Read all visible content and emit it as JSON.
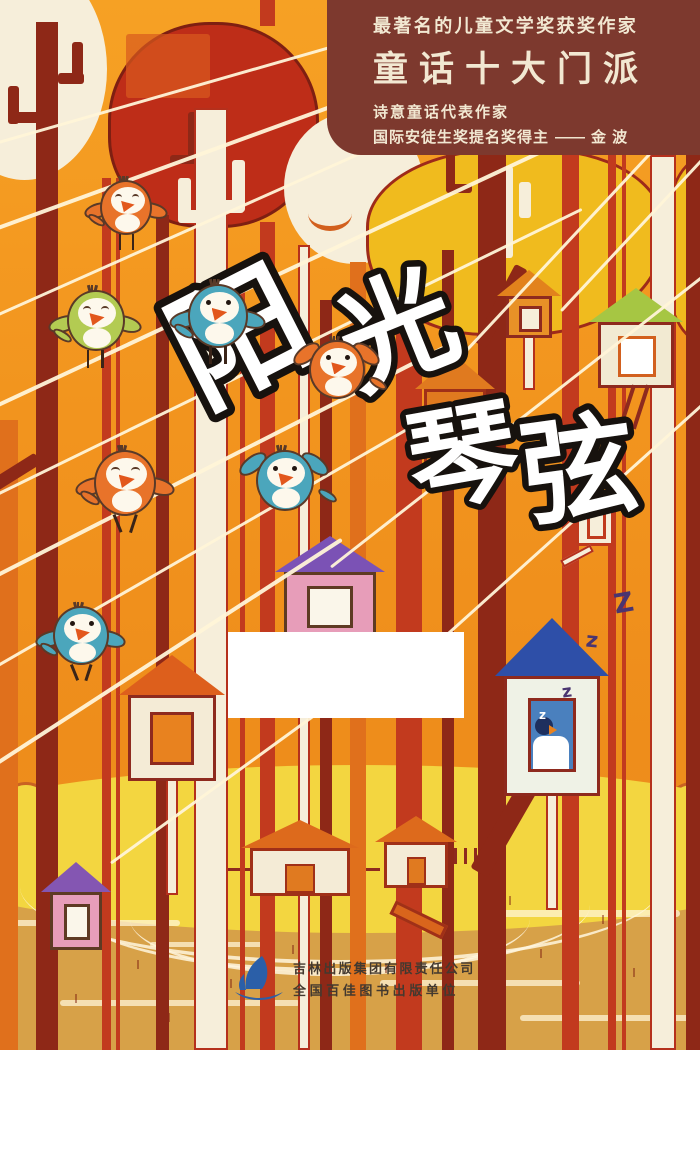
{
  "header": {
    "line1": "最著名的儿童文学奖获奖作家",
    "line2": "童话十大门派",
    "line3": "诗意童话代表作家",
    "line4_prefix": "国际安徒生奖提名奖得主",
    "line4_dash": "——",
    "line4_author": "金 波",
    "bg_color": "#7d392e",
    "text_color": "#f2e8d2"
  },
  "title": {
    "chars": [
      "阳",
      "光",
      "琴",
      "弦"
    ],
    "fill": "#ffffff",
    "stroke": "#17120e",
    "placement": [
      {
        "x": 150,
        "y": 248,
        "size": 132,
        "rot": -27
      },
      {
        "x": 305,
        "y": 236,
        "size": 116,
        "rot": -22
      },
      {
        "x": 372,
        "y": 360,
        "size": 110,
        "rot": -10
      },
      {
        "x": 488,
        "y": 374,
        "size": 114,
        "rot": -8
      }
    ]
  },
  "publisher": {
    "line1": "吉林出版集团有限责任公司",
    "line2": "全国百佳图书出版单位",
    "logo": "sailboat-logo",
    "logo_color": "#2b5fa8",
    "text_color": "#43392f"
  },
  "sleep_letters": [
    {
      "t": "z",
      "x": 562,
      "y": 682,
      "s": 17,
      "c": "#4a3570",
      "rot": -8
    },
    {
      "t": "z",
      "x": 586,
      "y": 628,
      "s": 21,
      "c": "#4a3570",
      "rot": 6
    },
    {
      "t": "Z",
      "x": 614,
      "y": 588,
      "s": 27,
      "c": "#4a3570",
      "rot": -10
    },
    {
      "t": "z",
      "x": 539,
      "y": 708,
      "s": 12,
      "c": "#ffffff",
      "rot": 0
    }
  ],
  "palette": {
    "sky_orange": "#f2941e",
    "maroon": "#8e2817",
    "red": "#c23a1e",
    "orange_trunk": "#e0701c",
    "cream": "#f6eeda",
    "canopy_red": "#be2d18",
    "canopy_yellow": "#f0bb1e",
    "bush_yellow": "#f3d640",
    "ground_tan": "#d7a148",
    "string_white": "#fff4d8",
    "bird_blue": "#4ba6bc",
    "bird_orange": "#e8732a",
    "bird_green": "#b3cb52",
    "outline_brown": "#5a3a28"
  },
  "scene": {
    "canopies": [
      {
        "n": "canopy-cream-left",
        "x": -58,
        "y": -42,
        "w": 165,
        "h": 222,
        "c": "#f6eeda",
        "rad": "50%",
        "bc": "none"
      },
      {
        "n": "canopy-red",
        "x": 108,
        "y": 22,
        "w": 205,
        "h": 200,
        "c": "#be2d18",
        "rad": "48% 48% 46% 44%",
        "bc": "#7e1f12"
      },
      {
        "n": "canopy-cream-mid",
        "x": 284,
        "y": 112,
        "w": 140,
        "h": 152,
        "c": "#f6eeda",
        "rad": "50%",
        "bc": "none"
      },
      {
        "n": "canopy-yellow",
        "x": 366,
        "y": 148,
        "w": 292,
        "h": 182,
        "c": "#f0bb1e",
        "rad": "46% 42% 46% 40% / 42% 40% 52% 48%",
        "bc": "#9e2a1a"
      },
      {
        "n": "canopy-yellow-right",
        "x": 662,
        "y": 158,
        "w": 70,
        "h": 178,
        "c": "#f0bb1e",
        "rad": "50% 0 0 50%",
        "bc": "#9e2a1a"
      }
    ],
    "canopy_marks": [
      {
        "n": "red-canopy-highlight",
        "x": 126,
        "y": 34,
        "w": 84,
        "h": 64,
        "c": "#d85a1e",
        "rad": "50%",
        "op": 0.7
      },
      {
        "n": "red-canopy-hook-v",
        "x": 188,
        "y": 112,
        "w": 9,
        "h": 52,
        "c": "#8e2817"
      },
      {
        "n": "red-canopy-hook-h",
        "x": 170,
        "y": 155,
        "w": 27,
        "h": 9,
        "c": "#8e2817"
      },
      {
        "n": "cream-canopy-smile",
        "x": 308,
        "y": 196,
        "w": 44,
        "h": 30,
        "c": "none",
        "arc": "#d2601e"
      },
      {
        "n": "yellow-canopy-white-bar",
        "x": 497,
        "y": 166,
        "w": 16,
        "h": 92,
        "c": "#f6eeda"
      },
      {
        "n": "yellow-canopy-white-stub-l",
        "x": 479,
        "y": 196,
        "w": 12,
        "h": 32,
        "c": "#f6eeda"
      },
      {
        "n": "yellow-canopy-white-stub-r",
        "x": 519,
        "y": 182,
        "w": 12,
        "h": 36,
        "c": "#f6eeda"
      },
      {
        "n": "yellow-canopy-maroon-stub-v",
        "x": 446,
        "y": 152,
        "w": 9,
        "h": 40,
        "c": "#8e2817"
      },
      {
        "n": "yellow-canopy-maroon-stub-h",
        "x": 446,
        "y": 184,
        "w": 26,
        "h": 9,
        "c": "#8e2817"
      }
    ],
    "trunks": [
      {
        "x": 0,
        "w": 18,
        "c": "#e0701c",
        "t": 420,
        "b": 1050
      },
      {
        "x": 36,
        "w": 22,
        "c": "#8e2817",
        "t": 22,
        "b": 1050
      },
      {
        "x": 102,
        "w": 9,
        "c": "#c23a1e",
        "t": 178,
        "b": 1050
      },
      {
        "x": 116,
        "w": 4,
        "c": "#c23a1e",
        "t": 178,
        "b": 1050
      },
      {
        "x": 156,
        "w": 13,
        "c": "#8e2817",
        "t": 215,
        "b": 1050
      },
      {
        "x": 194,
        "w": 34,
        "c": "#f6eeda",
        "t": 108,
        "b": 1050,
        "bd": 1
      },
      {
        "x": 240,
        "w": 5,
        "c": "#c23a1e",
        "t": 285,
        "b": 1050
      },
      {
        "x": 260,
        "w": 15,
        "c": "#c23a1e",
        "t": 222,
        "b": 1050
      },
      {
        "x": 260,
        "w": 15,
        "c": "#c23a1e",
        "t": 0,
        "b": 26
      },
      {
        "x": 298,
        "w": 12,
        "c": "#f6eeda",
        "t": 245,
        "b": 1050,
        "bd": 1
      },
      {
        "x": 320,
        "w": 12,
        "c": "#8e2817",
        "t": 300,
        "b": 1050
      },
      {
        "x": 350,
        "w": 16,
        "c": "#e0701c",
        "t": 262,
        "b": 1050
      },
      {
        "x": 396,
        "w": 26,
        "c": "#c23a1e",
        "t": 330,
        "b": 1050
      },
      {
        "x": 442,
        "w": 12,
        "c": "#8e2817",
        "t": 250,
        "b": 1050
      },
      {
        "x": 478,
        "w": 28,
        "c": "#8e2817",
        "t": 155,
        "b": 1050
      },
      {
        "x": 562,
        "w": 17,
        "c": "#c23a1e",
        "t": 155,
        "b": 1050
      },
      {
        "x": 608,
        "w": 8,
        "c": "#c23a1e",
        "t": 155,
        "b": 1050
      },
      {
        "x": 622,
        "w": 4,
        "c": "#c23a1e",
        "t": 155,
        "b": 1050
      },
      {
        "x": 650,
        "w": 26,
        "c": "#f6eeda",
        "t": 155,
        "b": 1050,
        "bd": 1
      },
      {
        "x": 686,
        "w": 14,
        "c": "#8e2817",
        "t": 155,
        "b": 1050
      }
    ],
    "branches": [
      {
        "x": 8,
        "y": 86,
        "w": 11,
        "h": 38,
        "c": "#8e2817"
      },
      {
        "x": 8,
        "y": 112,
        "w": 36,
        "h": 11,
        "c": "#8e2817"
      },
      {
        "x": 72,
        "y": 42,
        "w": 11,
        "h": 42,
        "c": "#8e2817"
      },
      {
        "x": 58,
        "y": 73,
        "w": 26,
        "h": 11,
        "c": "#8e2817"
      },
      {
        "x": 178,
        "y": 178,
        "w": 13,
        "h": 44,
        "c": "#f6eeda"
      },
      {
        "x": 178,
        "y": 210,
        "w": 28,
        "h": 13,
        "c": "#f6eeda"
      },
      {
        "x": 232,
        "y": 160,
        "w": 13,
        "h": 52,
        "c": "#f6eeda"
      },
      {
        "x": 218,
        "y": 200,
        "w": 26,
        "h": 13,
        "c": "#f6eeda"
      },
      {
        "x": -12,
        "y": 466,
        "w": 54,
        "h": 13,
        "c": "#8e2817",
        "rot": -32
      },
      {
        "x": 494,
        "y": 262,
        "w": 14,
        "h": 88,
        "c": "#8e2817",
        "rot": 28
      },
      {
        "x": 497,
        "y": 768,
        "w": 20,
        "h": 112,
        "c": "#8e2817",
        "rot": 30
      }
    ],
    "strings": [
      {
        "x": -40,
        "y": 152,
        "len": 820,
        "rot": -16,
        "h": 3
      },
      {
        "x": -30,
        "y": 236,
        "len": 790,
        "rot": -20,
        "h": 4
      },
      {
        "x": -40,
        "y": 330,
        "len": 580,
        "rot": -24,
        "h": 3
      },
      {
        "x": -30,
        "y": 416,
        "len": 700,
        "rot": -25,
        "h": 4
      },
      {
        "x": -30,
        "y": 506,
        "len": 680,
        "rot": -26,
        "h": 3
      },
      {
        "x": -40,
        "y": 592,
        "len": 560,
        "rot": -27,
        "h": 4
      },
      {
        "x": -30,
        "y": 680,
        "len": 520,
        "rot": -30,
        "h": 3
      },
      {
        "x": -20,
        "y": 772,
        "len": 430,
        "rot": -33,
        "h": 4
      },
      {
        "x": 110,
        "y": 862,
        "len": 380,
        "rot": -36,
        "h": 3
      },
      {
        "x": 330,
        "y": 566,
        "len": 520,
        "rot": -38,
        "h": 3
      },
      {
        "x": 430,
        "y": 648,
        "len": 420,
        "rot": -42,
        "h": 3
      },
      {
        "x": 450,
        "y": 366,
        "len": 420,
        "rot": -47,
        "h": 3
      },
      {
        "x": 560,
        "y": 310,
        "len": 260,
        "rot": -47,
        "h": 3
      }
    ],
    "houses": [
      {
        "n": "birdhouse-orange-small",
        "x": 506,
        "y": 270,
        "w": 46,
        "bh": 42,
        "rh": 26,
        "rc": "#e2821c",
        "bc": "#e89127",
        "wc": "#f6eeda",
        "oc": "#8e2a1e",
        "pole": 56
      },
      {
        "n": "birdhouse-green-roof",
        "x": 598,
        "y": 288,
        "w": 76,
        "bh": 66,
        "rh": 34,
        "rc": "#a6c643",
        "bc": "#f2ead2",
        "wc": "#ffffff",
        "wb": "#d2601e",
        "oc": "#8e2a1e",
        "ladder": 1
      },
      {
        "n": "birdhouse-tall-orange",
        "x": 424,
        "y": 355,
        "w": 62,
        "bh": 88,
        "rh": 34,
        "rc": "#e07a1f",
        "bc": "#e07a1f",
        "wc": "#e8a23f",
        "oc": "#a03018"
      },
      {
        "n": "board-sign-white",
        "x": 576,
        "y": 500,
        "w": 38,
        "bh": 46,
        "rh": 0,
        "bc": "#f6eeda",
        "wc": "#f6eeda",
        "wb": "#c03a1e",
        "oc": "#c03a1e",
        "stick": 1
      },
      {
        "n": "birdhouse-pink-purple",
        "x": 284,
        "y": 536,
        "w": 92,
        "bh": 68,
        "rh": 36,
        "rc": "#7b52b5",
        "bc": "#e79db9",
        "wc": "#faf6ea",
        "oc": "#5e3a23"
      },
      {
        "n": "birdhouse-white-orange",
        "x": 128,
        "y": 655,
        "w": 88,
        "bh": 86,
        "rh": 40,
        "rc": "#dd5f1c",
        "bc": "#f4ebd6",
        "wc": "#e8821f",
        "oc": "#8e2a1e",
        "pole": 118
      },
      {
        "n": "birdhouse-sleeping",
        "x": 504,
        "y": 618,
        "w": 96,
        "bh": 120,
        "rh": 58,
        "rc": "#2e4fa8",
        "bc": "#eff2e6",
        "wc": "#4a80be",
        "oc": "#8e2a1e",
        "pole": 118,
        "sleeper": 1
      },
      {
        "n": "house-pink-small",
        "x": 50,
        "y": 862,
        "w": 52,
        "bh": 58,
        "rh": 30,
        "rc": "#8456b2",
        "bc": "#e79db9",
        "wc": "#faf6ea",
        "oc": "#5e3a23"
      },
      {
        "n": "ground-house-1",
        "x": 250,
        "y": 820,
        "w": 100,
        "bh": 48,
        "rh": 28,
        "rc": "#dd6a1c",
        "bc": "#f4ebd6",
        "oc": "#a03018",
        "door": 1,
        "flat": 1
      },
      {
        "n": "ground-house-2",
        "x": 384,
        "y": 816,
        "w": 64,
        "bh": 46,
        "rh": 26,
        "rc": "#dd6a1c",
        "bc": "#f4ebd6",
        "oc": "#a03018",
        "door": 1,
        "flat": 1
      },
      {
        "n": "fallen-plank",
        "x": 388,
        "y": 912,
        "w": 58,
        "bh": 15,
        "rh": 0,
        "bc": "#d9651c",
        "oc": "#a03018",
        "rot": 26
      }
    ],
    "birds": [
      {
        "n": "bird-orange-perched-top",
        "x": 90,
        "y": 180,
        "s": 52,
        "c": "#e8732a",
        "pose": "perched",
        "face": "singing"
      },
      {
        "n": "bird-green-parakeet",
        "x": 55,
        "y": 290,
        "s": 58,
        "c": "#b3cb52",
        "pose": "perched",
        "face": "singing"
      },
      {
        "n": "bird-blue-upper",
        "x": 176,
        "y": 284,
        "s": 60,
        "c": "#4ba6bc",
        "pose": "perched",
        "face": "open"
      },
      {
        "n": "bird-orange-flying",
        "x": 298,
        "y": 340,
        "s": 56,
        "c": "#e8732a",
        "pose": "flying",
        "face": "open"
      },
      {
        "n": "bird-orange-dancing",
        "x": 82,
        "y": 450,
        "s": 62,
        "c": "#e8732a",
        "pose": "dancing",
        "face": "singing"
      },
      {
        "n": "bird-blue-flying",
        "x": 244,
        "y": 450,
        "s": 58,
        "c": "#4ba6bc",
        "pose": "flying",
        "face": "open"
      },
      {
        "n": "bird-blue-lower",
        "x": 42,
        "y": 606,
        "s": 56,
        "c": "#4ba6bc",
        "pose": "dancing",
        "face": "open"
      }
    ],
    "ground": {
      "tan_top": 866,
      "bush_band_top": 804,
      "bush_color": "#f3d640",
      "bush_outline": "#c96222",
      "tan_color": "#d7a148",
      "fence_color": "#8e2a1e"
    }
  }
}
